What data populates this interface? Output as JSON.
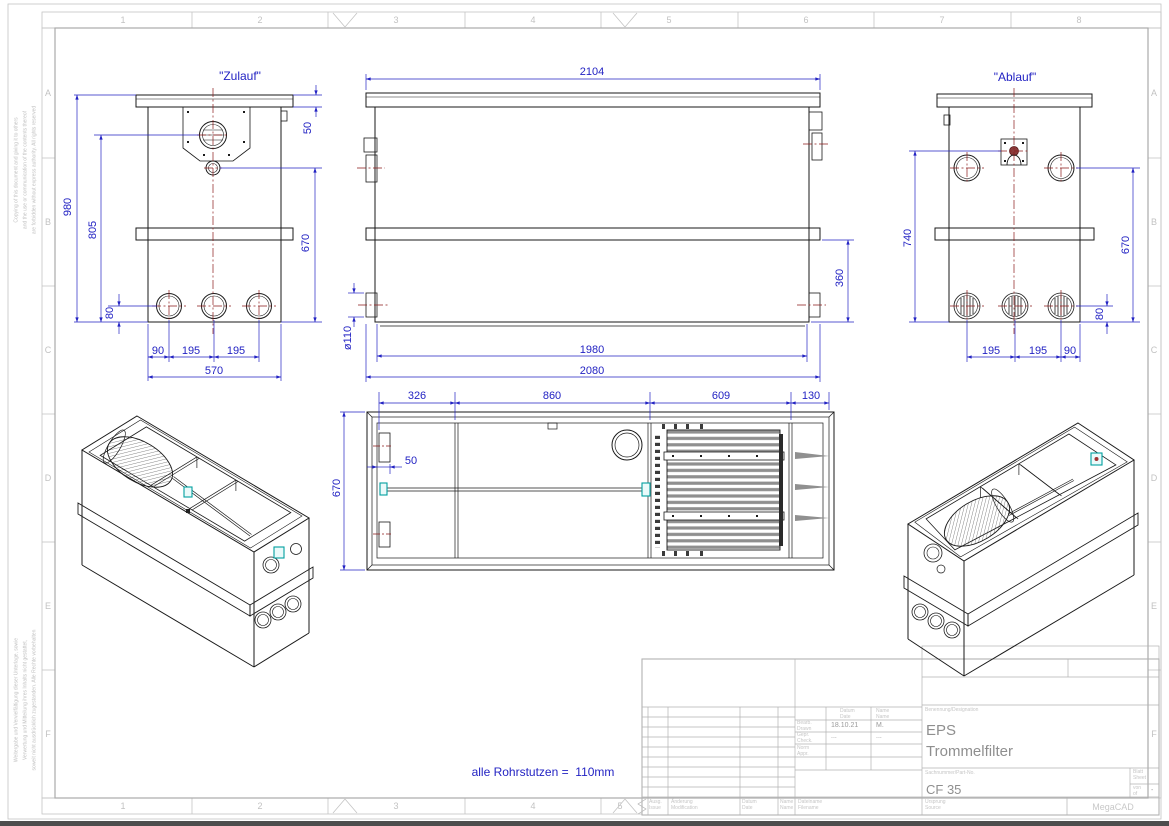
{
  "frame": {
    "top_numbers": [
      "1",
      "2",
      "3",
      "4",
      "5",
      "6",
      "7",
      "8"
    ],
    "bottom_numbers": [
      "1",
      "2",
      "3",
      "4",
      "5"
    ],
    "row_letters": [
      "A",
      "B",
      "C",
      "D",
      "E",
      "F"
    ],
    "disclaimer_top": "Copying of this document and giving it to others\nand the use or communication of the contents thereof\nare forbidden without express authority. All rights reserved",
    "disclaimer_bottom": "Weitergabe und Vervielfältigung dieser Unterlage, sowie\nVerwertung und Mitteilung ihres Inhalts nicht gestattet,\nsoweit nicht ausdrücklich zugestanden. Alle Rechte vorbehalten"
  },
  "labels": {
    "inlet": "\"Zulauf\"",
    "outlet": "\"Ablauf\"",
    "note": "alle Rohrstutzen =  110mm"
  },
  "dimensions": {
    "front": {
      "height_total": "980",
      "inlet_height": "805",
      "flange_offset": "50",
      "band_height": "670",
      "port_offset": "80",
      "port_edge": "90",
      "port_pitch1": "195",
      "port_pitch2": "195",
      "width": "570"
    },
    "side": {
      "length_top": "2104",
      "band_height": "360",
      "pipe_dia": "ø110",
      "inner_length": "1980",
      "body_length": "2080"
    },
    "rear": {
      "outlet_height": "740",
      "band_height": "670",
      "port_offset": "80",
      "pitch1": "195",
      "pitch2": "195",
      "edge": "90"
    },
    "plan": {
      "seg1": "326",
      "seg2": "860",
      "seg3": "609",
      "seg4": "130",
      "offset": "50",
      "width": "670"
    }
  },
  "title_block": {
    "designation_label": "Benennung/Designation",
    "designation": "EPS\nTrommelfilter",
    "part_label": "Sachnummer/Part-No.",
    "part_no": "CF 35",
    "date_label": "Datum\nDate",
    "name_label": "Name\nName",
    "drawn_label": "Bearb.\nDrawn",
    "checked_label": "Gepr.\nCheck.",
    "approved_label": "Norm\nAppr.",
    "drawn_date": "18.10.21",
    "drawn_name": "M.",
    "checked_date": "...",
    "checked_name": "...",
    "sheet_label": "Blatt\nSheet",
    "of_label": "von\nof",
    "of_value": "-",
    "issue_label": "Ausg.\nIssue",
    "modification_label": "Änderung\nModification",
    "date2_label": "Datum\nDate",
    "name2_label": "Name\nName",
    "filename_label": "Dateiname\nFilename",
    "source_label": "Ursprung\nSource",
    "cad": "MegaCAD"
  },
  "colors": {
    "dimension_blue": "#2323c3",
    "centerline_red": "#8b1a1a",
    "drawing_line": "#1a1a1a",
    "frame_gray": "#c2c2c2",
    "accent_teal": "#00a0a0"
  }
}
